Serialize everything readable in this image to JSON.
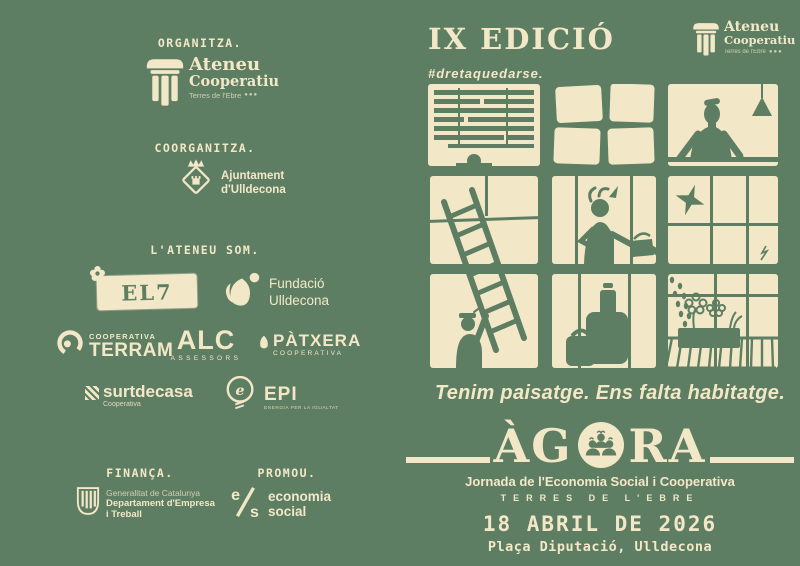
{
  "colors": {
    "background": "#5e7e63",
    "ink": "#f2e8c7"
  },
  "left_page": {
    "sections": {
      "organitza": "ORGANITZA.",
      "coorganitza": "COORGANITZA.",
      "ateneu_som": "L'ATENEU SOM.",
      "financa": "FINANÇA.",
      "promou": "PROMOU."
    },
    "logos": {
      "ateneu": {
        "name1": "Ateneu",
        "name2": "Cooperatiu",
        "sub": "Terres de l'Ebre",
        "dots": "●●●"
      },
      "ajuntament": {
        "line1": "Ajuntament",
        "line2": "d'Ulldecona"
      },
      "el7": {
        "text": "EL7"
      },
      "fundacio": {
        "line1": "Fundació",
        "line2": "Ulldecona"
      },
      "terram": {
        "top": "COOPERATIVA",
        "name": "TERRAM"
      },
      "alc": {
        "name": "ALC",
        "sub": "ASSESSORS"
      },
      "patxera": {
        "name": "PÀTXERA",
        "sub": "COOPERATIVA"
      },
      "surtdecasa": {
        "name": "surtdecasa",
        "sub": "Cooperativa"
      },
      "epi": {
        "glyph": "e",
        "name": "EPI",
        "sub": "ENERGIA PER LA IGUALTAT"
      },
      "generalitat": {
        "line1": "Generalitat de Catalunya",
        "line2": "Departament d'Empresa",
        "line3": "i Treball"
      },
      "economia_social": {
        "glyph_top": "e",
        "glyph_bottom": "s",
        "line1": "economia",
        "line2": "social"
      }
    }
  },
  "right_page": {
    "edition": "IX EDICIÓ",
    "hashtag": "#dretaquedarse.",
    "ateneu": {
      "name1": "Ateneu",
      "name2": "Cooperatiu",
      "sub": "Terres de l'Ebre",
      "dots": "●●●"
    },
    "illustration": "nine-windows-neighbours-scene",
    "tagline": "Tenim paisatge. Ens falta habitatge.",
    "agora": {
      "pre": "ÀG",
      "post": "RA",
      "subtitle": "Jornada de l'Economia Social i Cooperativa",
      "territory": "TERRES DE L'EBRE"
    },
    "event": {
      "date": "18 ABRIL DE 2026",
      "location": "Plaça Diputació, Ulldecona"
    }
  }
}
